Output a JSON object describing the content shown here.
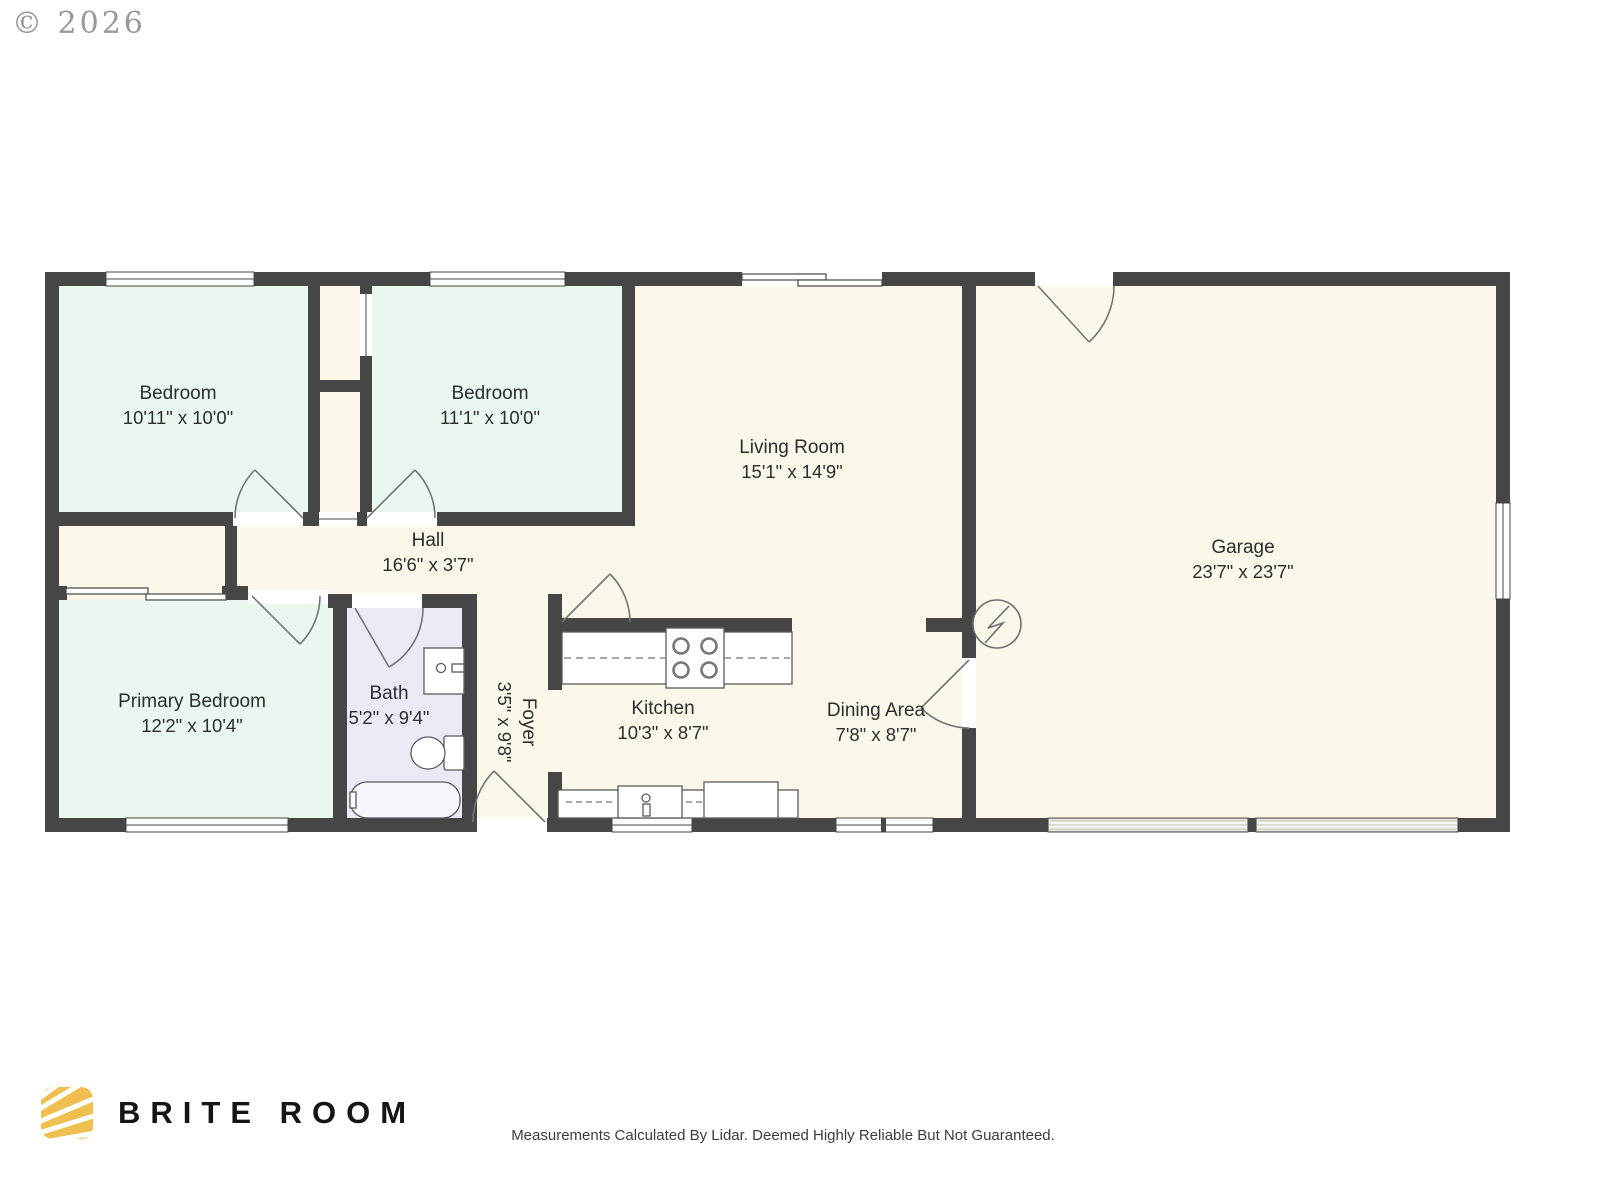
{
  "copyright": "© 2026",
  "rooms": {
    "bedroom1": {
      "name": "Bedroom",
      "dims": "10'11\" x 10'0\""
    },
    "bedroom2": {
      "name": "Bedroom",
      "dims": "11'1\" x 10'0\""
    },
    "living": {
      "name": "Living Room",
      "dims": "15'1\" x 14'9\""
    },
    "garage": {
      "name": "Garage",
      "dims": "23'7\" x 23'7\""
    },
    "hall": {
      "name": "Hall",
      "dims": "16'6\" x 3'7\""
    },
    "primary": {
      "name": "Primary Bedroom",
      "dims": "12'2\" x 10'4\""
    },
    "bath": {
      "name": "Bath",
      "dims": "5'2\" x 9'4\""
    },
    "foyer": {
      "name": "Foyer",
      "dims": "3'5\" x 9'8\""
    },
    "kitchen": {
      "name": "Kitchen",
      "dims": "10'3\" x 8'7\""
    },
    "dining": {
      "name": "Dining Area",
      "dims": "7'8\" x 8'7\""
    }
  },
  "footer": {
    "brand": "BRITE ROOM",
    "disclaimer": "Measurements Calculated By Lidar. Deemed Highly Reliable But Not Guaranteed."
  },
  "colors": {
    "wall": "#464646",
    "room_cream": "#fbf8ea",
    "room_mint": "#e9f7ef",
    "room_lavender": "#e9eaf6",
    "logo_gold": "#efc04f"
  }
}
